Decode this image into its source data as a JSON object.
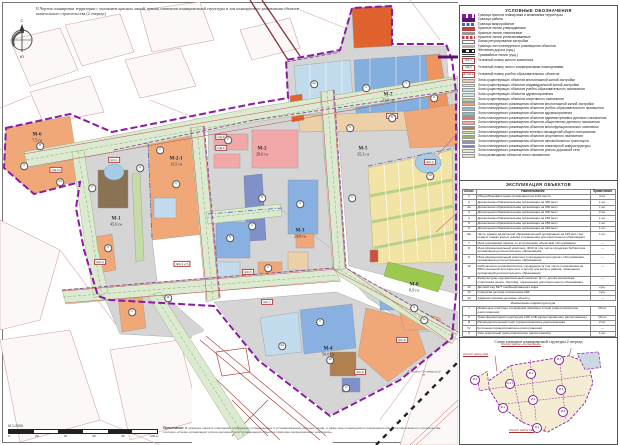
{
  "page": {
    "title": "II.Чертеж планировки территории с указанием красных линий, границ элементов планировочной структуры и зон планируемого размещения объектов капитального строительства (2 очередь)",
    "compass": {
      "north": "С",
      "south": "Ю"
    },
    "scale": {
      "label": "М 1:2000",
      "ticks": [
        "0",
        "20",
        "40",
        "60",
        "80",
        "100 м"
      ]
    },
    "note_title": "Примечание:",
    "note_text": "В границах проекта планировки отображены установленные и устанавливаемые красные линии, а также зоны планируемого размещения объектов капитального строительства согласно «Схеме организации улично-дорожной сети и размещения объектов природно-рекреационного комплекса»."
  },
  "map": {
    "districts": [
      {
        "id": "М-6",
        "area": "7,5 га",
        "x": 37,
        "y": 138
      },
      {
        "id": "М-2-1",
        "area": "11,5 га",
        "x": 176,
        "y": 162
      },
      {
        "id": "М-1",
        "area": "45,6 га",
        "x": 116,
        "y": 222
      },
      {
        "id": "М-2",
        "area": "28,6 га",
        "x": 262,
        "y": 152
      },
      {
        "id": "М-5",
        "area": "35,3 га",
        "x": 363,
        "y": 152
      },
      {
        "id": "М-7",
        "area": "22,5 га",
        "x": 388,
        "y": 98
      },
      {
        "id": "М-3",
        "area": "24,8 га",
        "x": 300,
        "y": 234
      },
      {
        "id": "М-8",
        "area": "8,9 га",
        "x": 414,
        "y": 288
      },
      {
        "id": "М-4",
        "area": "50,0 га",
        "x": 328,
        "y": 352
      }
    ],
    "tags": [
      {
        "label": "ОД-10",
        "x": 56,
        "y": 170
      },
      {
        "label": "ЖК-1",
        "x": 114,
        "y": 160
      },
      {
        "label": "ОД-8",
        "x": 221,
        "y": 137
      },
      {
        "label": "ОД-6",
        "x": 221,
        "y": 148
      },
      {
        "label": "ЖК-3",
        "x": 100,
        "y": 262
      },
      {
        "label": "ЖК-4 и 5",
        "x": 182,
        "y": 264
      },
      {
        "label": "ЖК-5",
        "x": 248,
        "y": 272
      },
      {
        "label": "ЖК-7",
        "x": 267,
        "y": 302
      },
      {
        "label": "ЖК-6",
        "x": 430,
        "y": 162
      },
      {
        "label": "ЖК-7",
        "x": 392,
        "y": 116
      },
      {
        "label": "ЖК-8",
        "x": 360,
        "y": 372
      },
      {
        "label": "ЖК-8",
        "x": 402,
        "y": 340
      }
    ],
    "circles": [
      {
        "n": "8",
        "x": 40,
        "y": 146
      },
      {
        "n": "3",
        "x": 24,
        "y": 166
      },
      {
        "n": "14",
        "x": 60,
        "y": 182
      },
      {
        "n": "7",
        "x": 92,
        "y": 188
      },
      {
        "n": "4",
        "x": 140,
        "y": 168
      },
      {
        "n": "3",
        "x": 108,
        "y": 248
      },
      {
        "n": "1",
        "x": 132,
        "y": 312
      },
      {
        "n": "11",
        "x": 168,
        "y": 298
      },
      {
        "n": "2",
        "x": 160,
        "y": 150
      },
      {
        "n": "6",
        "x": 176,
        "y": 184
      },
      {
        "n": "2",
        "x": 228,
        "y": 140
      },
      {
        "n": "8",
        "x": 262,
        "y": 198
      },
      {
        "n": "1",
        "x": 252,
        "y": 226
      },
      {
        "n": "4",
        "x": 300,
        "y": 204
      },
      {
        "n": "9",
        "x": 350,
        "y": 128
      },
      {
        "n": "5",
        "x": 392,
        "y": 118
      },
      {
        "n": "10",
        "x": 430,
        "y": 176
      },
      {
        "n": "1",
        "x": 352,
        "y": 198
      },
      {
        "n": "2а",
        "x": 314,
        "y": 84
      },
      {
        "n": "1",
        "x": 366,
        "y": 88
      },
      {
        "n": "3",
        "x": 406,
        "y": 84
      },
      {
        "n": "6",
        "x": 434,
        "y": 98
      },
      {
        "n": "5",
        "x": 230,
        "y": 238
      },
      {
        "n": "2",
        "x": 268,
        "y": 268
      },
      {
        "n": "1",
        "x": 320,
        "y": 322
      },
      {
        "n": "13",
        "x": 330,
        "y": 360
      },
      {
        "n": "2а",
        "x": 282,
        "y": 346
      },
      {
        "n": "9",
        "x": 346,
        "y": 388
      },
      {
        "n": "3",
        "x": 414,
        "y": 308
      },
      {
        "n": "12",
        "x": 424,
        "y": 320
      }
    ],
    "streets": [
      {
        "label": "Гарнизон Октябрьский пл.",
        "x": 424,
        "y": 374
      }
    ]
  },
  "legend": {
    "title": "УСЛОВНЫЕ ОБОЗНАЧЕНИЯ",
    "items": [
      {
        "cls": "sw sw-bound-proj",
        "label": "Граница проекта планировки и межевания территории"
      },
      {
        "cls": "sw sw-bound-rayon",
        "label": "Граница района"
      },
      {
        "cls": "sw sw-bound-micro",
        "label": "Граница микрорайонов"
      },
      {
        "cls": "sw sw-red-appr",
        "label": "Красные линии утверждаемые"
      },
      {
        "cls": "sw sw-red-cancel",
        "label": "Красные линии отменяемые"
      },
      {
        "cls": "sw sw-red-set",
        "label": "Красные линии устанавливаемые"
      },
      {
        "cls": "sw sw-reg-line",
        "label": "Линия регулирования застройки"
      },
      {
        "cls": "sw sw-zone-bord",
        "label": "Границы зон планируемого размещения объектов"
      },
      {
        "cls": "sw sw-rail",
        "label": "Железная дорога (сущ.)"
      },
      {
        "cls": "sw sw-tram",
        "label": "Трамвайные линии (сущ.)"
      },
      {
        "cls": "sw sw-tag",
        "tag": "ЖК-1",
        "label": "Условный номер жилого комплекса"
      },
      {
        "cls": "sw sw-tag",
        "tag": "ОД-2",
        "label": "Условный номер зоны с коммерческими помещениями"
      },
      {
        "cls": "sw sw-tag",
        "tag": "Д-1 Ш-1",
        "label": "Условный номер учебно-образовательных объектов"
      },
      {
        "cls": "sw sw-fill",
        "color": "#e9cba4",
        "label": "Зона существующих объектов многоэтажной жилой застройки"
      },
      {
        "cls": "sw sw-fill",
        "color": "#f3e7b3",
        "label": "Зона существующих объектов индивидуальной жилой застройки"
      },
      {
        "cls": "sw sw-fill",
        "color": "#c4dcee",
        "label": "Зона существующих объектов учебно-образовательного назначения"
      },
      {
        "cls": "sw sw-fill",
        "color": "#cfe8e4",
        "label": "Зона существующих объектов здравоохранения"
      },
      {
        "cls": "sw sw-fill",
        "color": "#b9d89a",
        "label": "Зона существующих объектов спортивного назначения"
      },
      {
        "cls": "sw sw-fill",
        "color": "#f0a070",
        "label": "Зона планируемого размещения объектов многоэтажной жилой застройки"
      },
      {
        "cls": "sw sw-fill",
        "color": "#8fb4dc",
        "label": "Зона планируемого размещения объектов учебно-образовательного назначения"
      },
      {
        "cls": "sw sw-fill",
        "color": "#7fc4bc",
        "label": "Зона планируемого размещения объектов здравоохранения"
      },
      {
        "cls": "sw sw-fill",
        "color": "#e07a5f",
        "label": "Зона планируемого размещения объектов административно-делового назначения"
      },
      {
        "cls": "sw sw-fill",
        "color": "#f0a8a8",
        "label": "Зона планируемого размещения объектов общественно-делового назначения"
      },
      {
        "cls": "sw sw-fill",
        "color": "#b08050",
        "label": "Зона планируемого размещения объектов многофункционального комплекса"
      },
      {
        "cls": "sw sw-fill",
        "color": "#c8e0a8",
        "label": "Зона планируемого размещения зеленых насаждений общего пользования"
      },
      {
        "cls": "sw sw-fill",
        "color": "#8cc060",
        "label": "Зона планируемого размещения объектов спортивного назначения"
      },
      {
        "cls": "sw sw-fill",
        "color": "#9098a8",
        "label": "Зона планируемого размещения объектов автомобильного транспорта"
      },
      {
        "cls": "sw sw-fill",
        "color": "#7878b0",
        "label": "Зона планируемого размещения объектов инженерной инфраструктуры"
      },
      {
        "cls": "sw sw-fill",
        "color": "#dcead0",
        "label": "Зона планируемого размещения объектов улично-дорожной сети"
      },
      {
        "cls": "sw sw-fill",
        "color": "#e0e0dc",
        "label": "Зона размещения объектов иного назначения"
      }
    ]
  },
  "table": {
    "title": "ЭКСПЛИКАЦИЯ ОБЪЕКТОВ",
    "columns": [
      "Обозн.",
      "Наименование",
      "Примечание"
    ],
    "rows": [
      {
        "cls": "",
        "c1": "1",
        "c2": "Общеобразовательная организация на 1101 место",
        "c3": "4 шт."
      },
      {
        "cls": "",
        "c1": "2",
        "c2": "Дошкольная образовательная организация на 350 мест",
        "c3": "1 шт."
      },
      {
        "cls": "",
        "c1": "2а",
        "c2": "Дошкольная образовательная организация на 300 мест",
        "c3": "1 шт."
      },
      {
        "cls": "",
        "c1": "3",
        "c2": "Дошкольная образовательная организация на 300 мест",
        "c3": "2 шт."
      },
      {
        "cls": "",
        "c1": "4",
        "c2": "Дошкольная образовательная организация на 260 мест",
        "c3": "1 шт."
      },
      {
        "cls": "",
        "c1": "5",
        "c2": "Дошкольная образовательная организация на 250 мест",
        "c3": "1 шт."
      },
      {
        "cls": "",
        "c1": "6",
        "c2": "Дошкольная образовательная организация на 220 мест",
        "c3": "1 шт."
      },
      {
        "cls": "",
        "c1": "6а",
        "c2": "Часть здания дошкольной образовательной организации на 145 мест (на первых этажах жилых домов) и помещения дополнительного образования",
        "c3": "1 шт."
      },
      {
        "cls": "",
        "c1": "7",
        "c2": "Многоуровневый паркинг со встроенными объектами обслуживания",
        "c3": "—"
      },
      {
        "cls": "",
        "c1": "8",
        "c2": "Многофункциональный комплекс, ФОК (в том числе городская библиотека, организации дополнительного образования)",
        "c3": "—"
      },
      {
        "cls": "",
        "c1": "9",
        "c2": "Многофункциональный комплекс (учреждения культурного обслуживания, организации дополнительного образования)",
        "c3": "—"
      },
      {
        "cls": "",
        "c1": "10",
        "c2": "Амбулаторно-поликлиническое учреждение (в том числе поликлиника на 580 посещений для взрослых и детей) для жилого района, помещения организаций дополнительного образования",
        "c3": "—"
      },
      {
        "cls": "",
        "c1": "11",
        "c2": "Физкультурно-оздоровительный комплекс (в т.ч. детско-юношеская спортивная школа, бассейн), организации дополнительного образования",
        "c3": "—"
      },
      {
        "cls": "",
        "c1": "12",
        "c2": "Детский сад №77 комбинированного вида",
        "c3": "сущ."
      },
      {
        "cls": "",
        "c1": "13",
        "c2": "Городская детская поликлиника №6",
        "c3": "сущ."
      },
      {
        "cls": "",
        "c1": "14",
        "c2": "Административно-деловые объекты",
        "c3": "—"
      },
      {
        "cls": "sec",
        "c1": "",
        "c2": "Инженерная инфраструктура",
        "c3": ""
      },
      {
        "cls": "",
        "c1": "I",
        "c2": "Локальные очистные сооружения ливневых стоков (ориентировочное расположение)",
        "c3": "10 шт."
      },
      {
        "cls": "",
        "c1": "II",
        "c2": "Трансформаторная подстанция 10/0,4 кВ (ориентировочное расположение)",
        "c3": "19 шт."
      },
      {
        "cls": "",
        "c1": "III",
        "c2": "Распределительный пункт (ориентировочное расположение)",
        "c3": "2 шт."
      },
      {
        "cls": "",
        "c1": "IV",
        "c2": "Котельная (ориентировочное расположение)",
        "c3": "—"
      },
      {
        "cls": "",
        "c1": "V",
        "c2": "Узел агрегатный (ориентировочное расположение)",
        "c3": "1 шт."
      },
      {
        "cls": "",
        "c1": "VI",
        "c2": "Газорегуляторный пункт (ориентировочное расположение)",
        "c3": "1 шт."
      },
      {
        "cls": "",
        "c1": "VII",
        "c2": "ПС 110 кВ (поставлена на эксплуатацию)",
        "c3": "сущ."
      }
    ]
  },
  "inset": {
    "title": "Схема элементов планировочной структуры 2 очереди",
    "callout_top": "Жилой район «Солнечный»",
    "callout_left": "Жилой район №2",
    "callout_bottom": "Жилой район №3",
    "units": [
      {
        "id": "М-6",
        "x": 14,
        "y": 36
      },
      {
        "id": "М-2-1",
        "x": 49,
        "y": 40
      },
      {
        "id": "М-2",
        "x": 70,
        "y": 30
      },
      {
        "id": "М-7",
        "x": 98,
        "y": 16
      },
      {
        "id": "М-5",
        "x": 100,
        "y": 46
      },
      {
        "id": "М-1",
        "x": 42,
        "y": 64
      },
      {
        "id": "М-3",
        "x": 72,
        "y": 56
      },
      {
        "id": "М-8",
        "x": 102,
        "y": 68
      },
      {
        "id": "М-4",
        "x": 76,
        "y": 84
      }
    ]
  }
}
